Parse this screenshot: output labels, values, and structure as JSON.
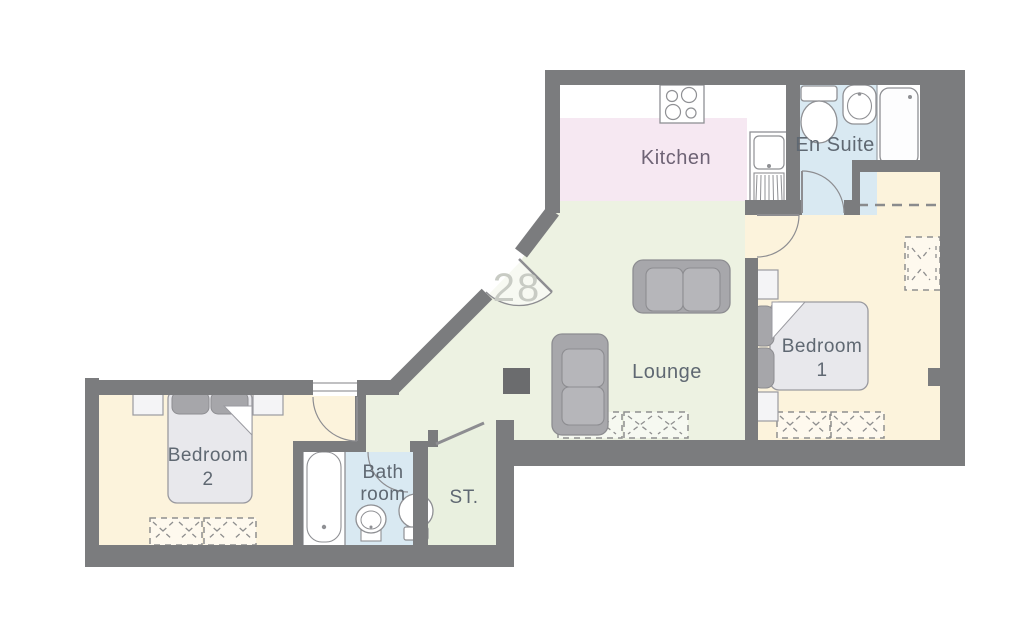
{
  "title": "Apartment floor plan",
  "unit": {
    "number": "28"
  },
  "rooms": {
    "kitchen": {
      "label": "Kitchen"
    },
    "en_suite": {
      "label": "En Suite"
    },
    "lounge": {
      "label": "Lounge"
    },
    "bedroom1": {
      "line1": "Bedroom",
      "line2": "1"
    },
    "bedroom2": {
      "line1": "Bedroom",
      "line2": "2"
    },
    "bathroom": {
      "line1": "Bath",
      "line2": "room"
    },
    "storage": {
      "label": "ST."
    }
  },
  "palette": {
    "wall": "#7b7c7e",
    "kitchen_floor": "#f6e8f2",
    "lounge_floor": "#edf2e2",
    "bedroom_floor": "#fcf3dc",
    "bathroom_floor": "#d9e9f2",
    "fixture_white": "#ffffff",
    "furniture_gray": "#a7a7ab",
    "cushion_gray": "#b6b6ba",
    "mattress_gray": "#e8e8ec",
    "column_dark": "#6b6c6e",
    "label_text": "#5f6872",
    "unit_number_text": "#c8cbc4"
  }
}
